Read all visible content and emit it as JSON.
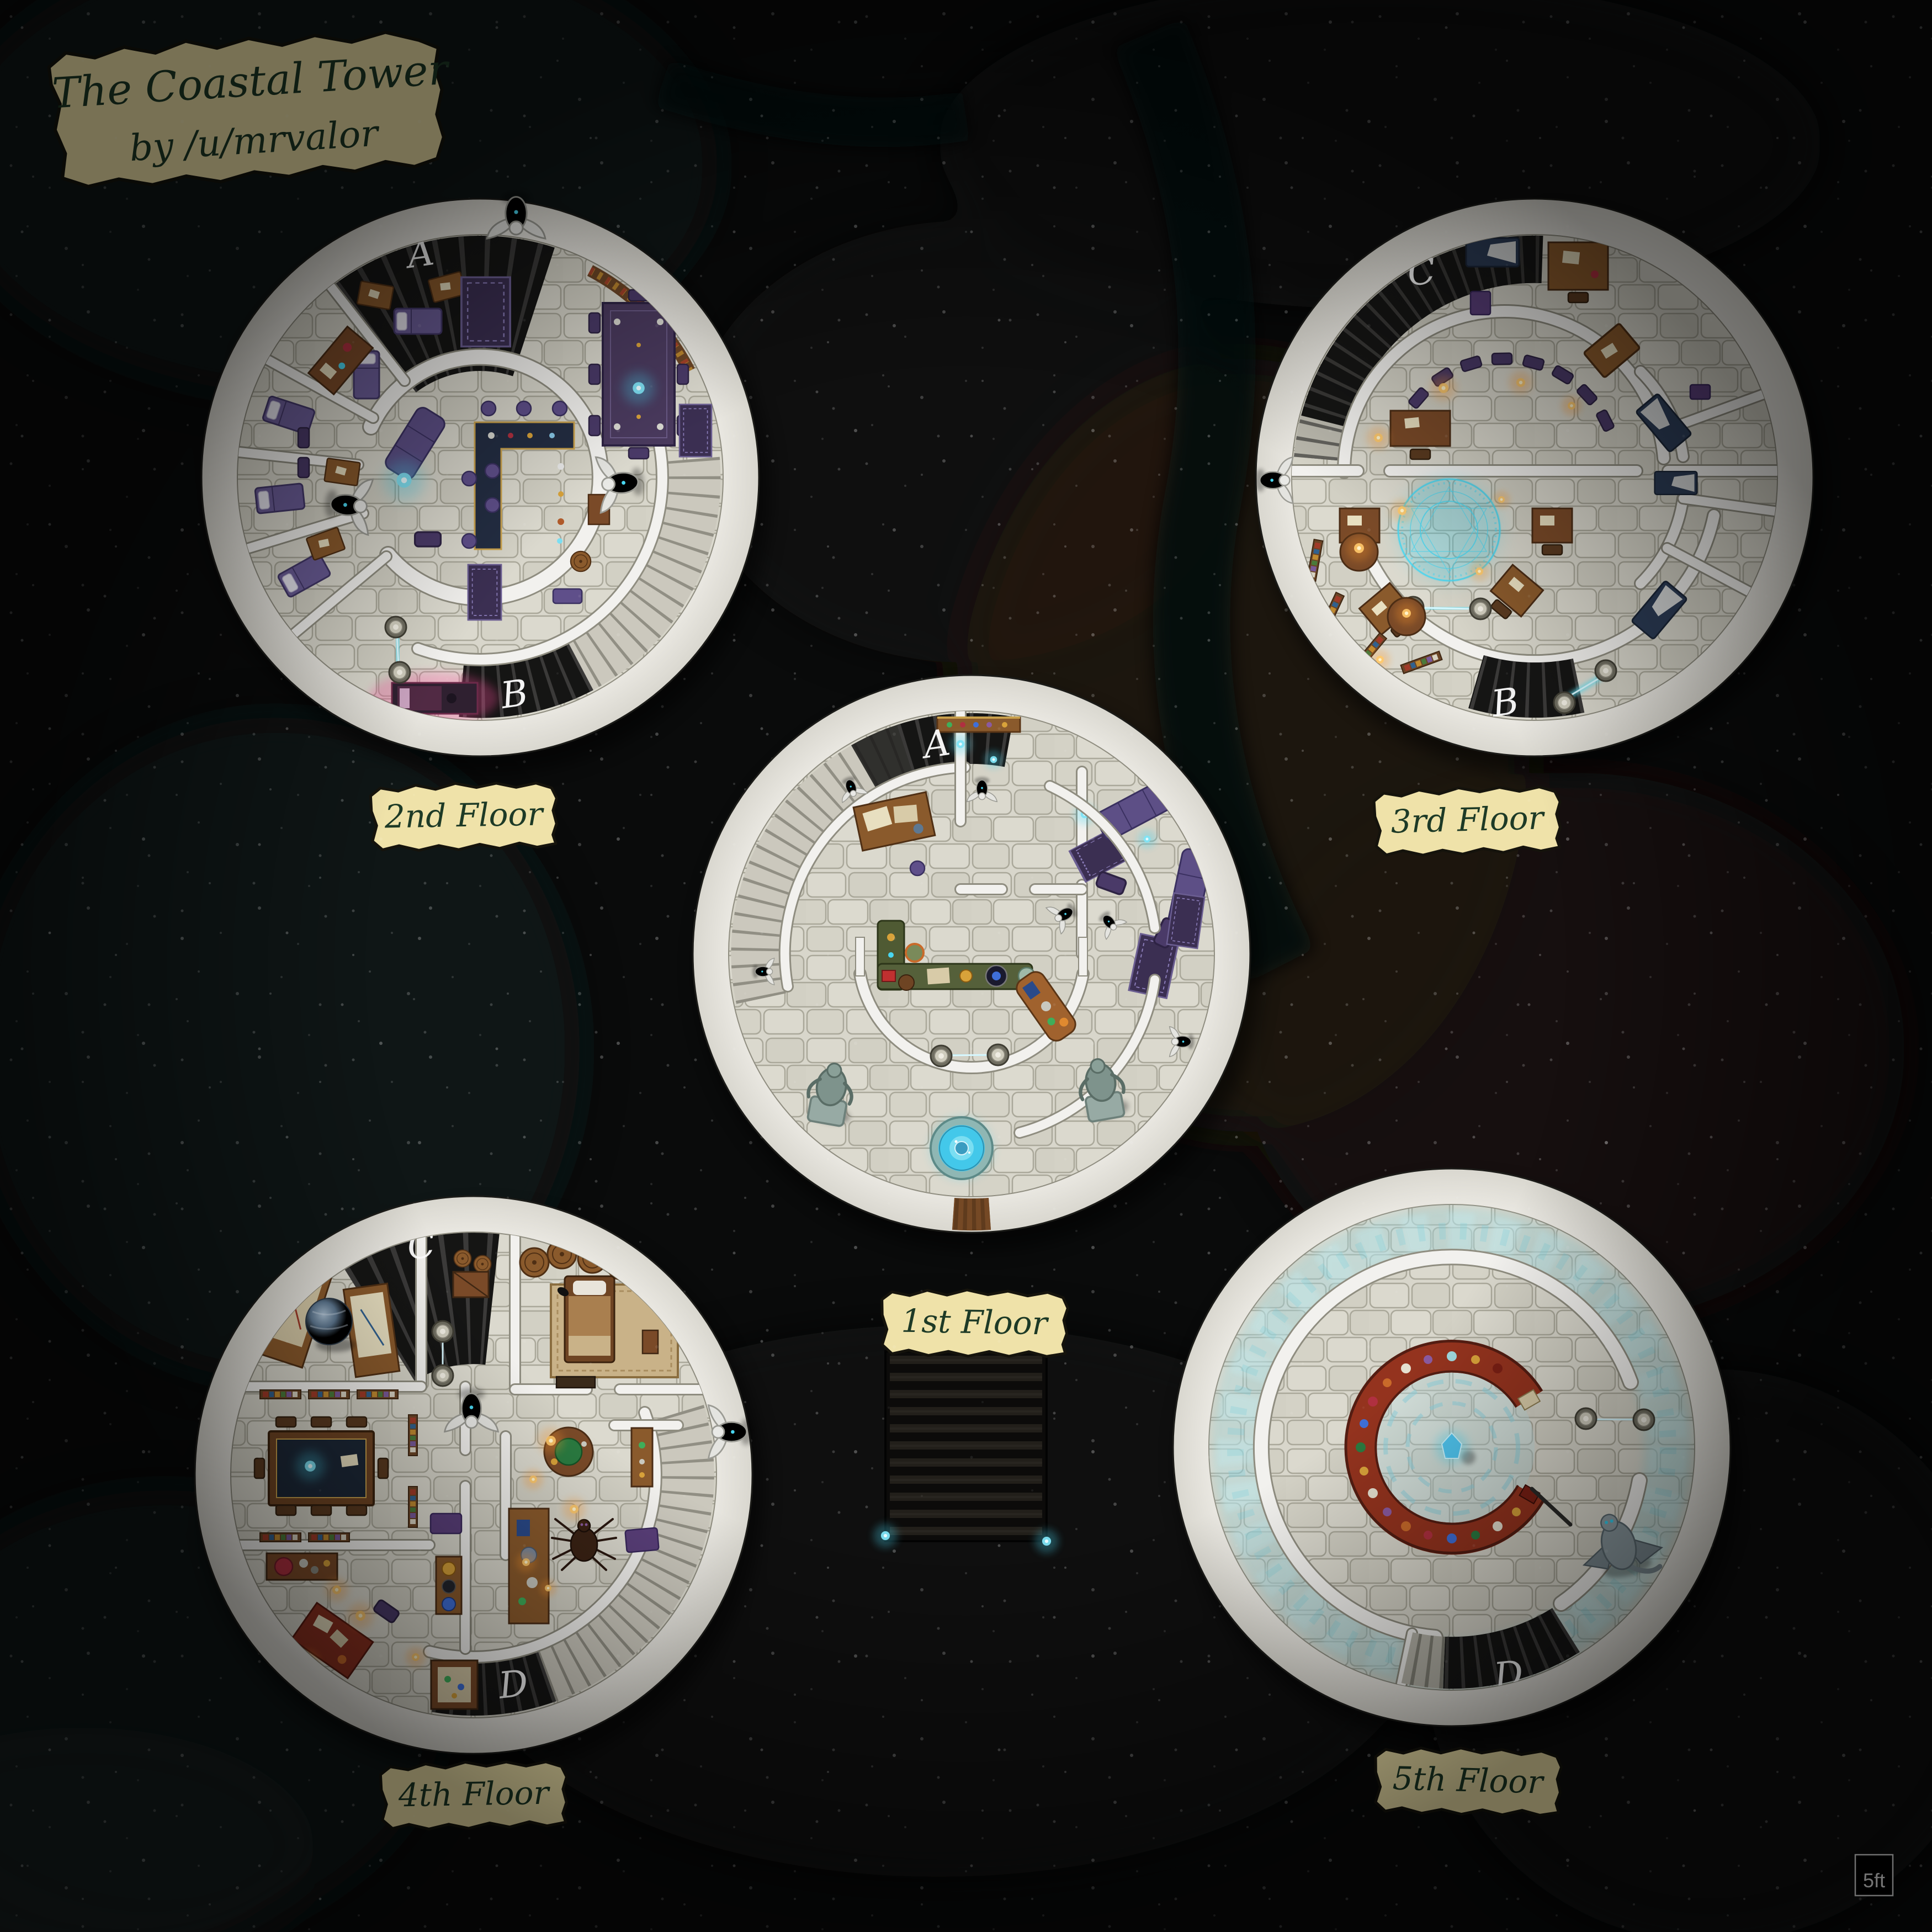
{
  "title_banner": {
    "line1": "The Coastal Tower",
    "line2": "by /u/mrvalor"
  },
  "floors": {
    "f1": {
      "label": "1st Floor",
      "stair_top": "A"
    },
    "f2": {
      "label": "2nd Floor",
      "stair_top": "A",
      "stair_bottom": "B"
    },
    "f3": {
      "label": "3rd Floor",
      "stair_top": "C",
      "stair_bottom": "B"
    },
    "f4": {
      "label": "4th Floor",
      "stair_top": "C",
      "stair_bottom": "D"
    },
    "f5": {
      "label": "5th Floor",
      "stair_bottom": "D"
    }
  },
  "scale_box": {
    "label": "5ft"
  },
  "palette": {
    "background": "#0a0b0b",
    "parchment": "#efe2a9",
    "banner_text_green": "#1d3a26",
    "marble_wall": "#f2f1ee",
    "stone_floor": "#d7d5ca",
    "stair_dark": "#151514",
    "glow_cyan": "#49d6f0",
    "glow_orange": "#ffb03a",
    "glow_magenta": "#ff4fa0",
    "furniture_purple": "#5d4f86",
    "bed_navy": "#2c3c56",
    "wood": "#8a5a2c",
    "library_ring_red": "#94331e",
    "ice": "#a8dce2"
  }
}
